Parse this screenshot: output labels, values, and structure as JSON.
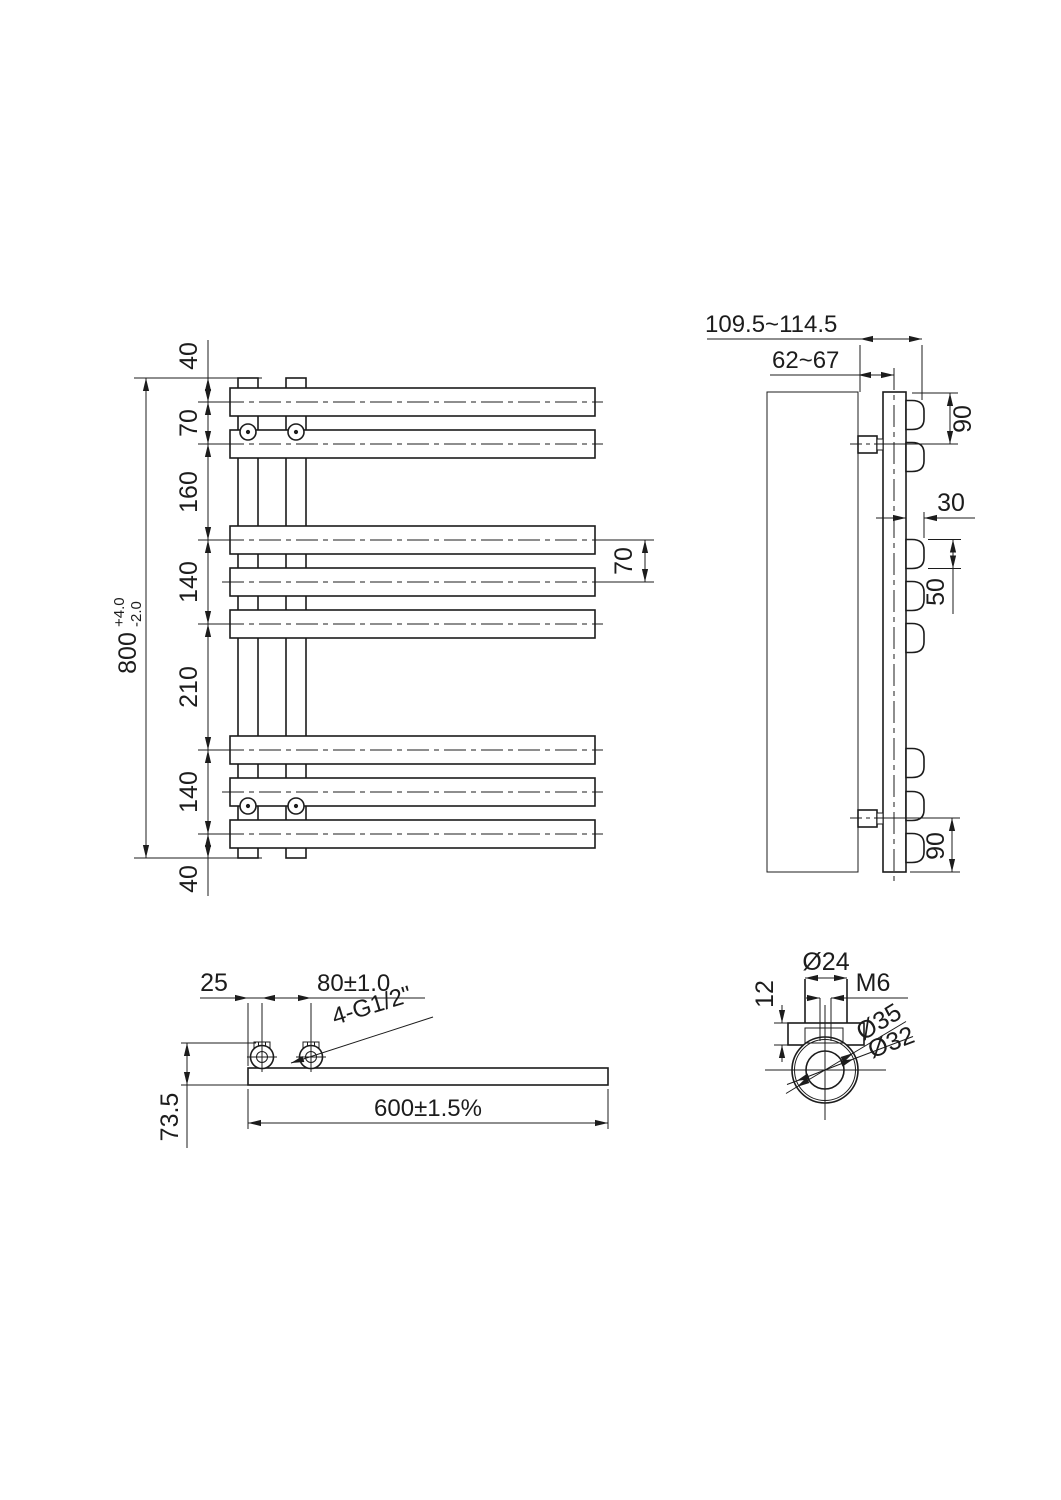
{
  "colors": {
    "ink": "#1c1c1c",
    "paper": "#ffffff"
  },
  "front": {
    "chain": [
      "40",
      "70",
      "160",
      "140",
      "210",
      "140",
      "40"
    ],
    "overall": "800",
    "tol_plus": "+4.0",
    "tol_minus": "-2.0",
    "bar_pitch": "70"
  },
  "side": {
    "depth_range": "109.5~114.5",
    "wall_to_axis": "62~67",
    "top_bracket_offset": "90",
    "bar_depth": "30",
    "bar_height": "50",
    "bottom_bracket_offset": "90"
  },
  "bottom": {
    "edge_to_valve": "25",
    "valve_pitch": "80±1.0",
    "thread_note": "4-G1/2\"",
    "depth_overall": "73.5",
    "width_overall": "600±1.5%"
  },
  "detail": {
    "boss_dia": "Ø24",
    "plate_thickness": "12",
    "screw_thread": "M6",
    "outer_dia": "Ø35",
    "inner_dia": "Ø32"
  }
}
